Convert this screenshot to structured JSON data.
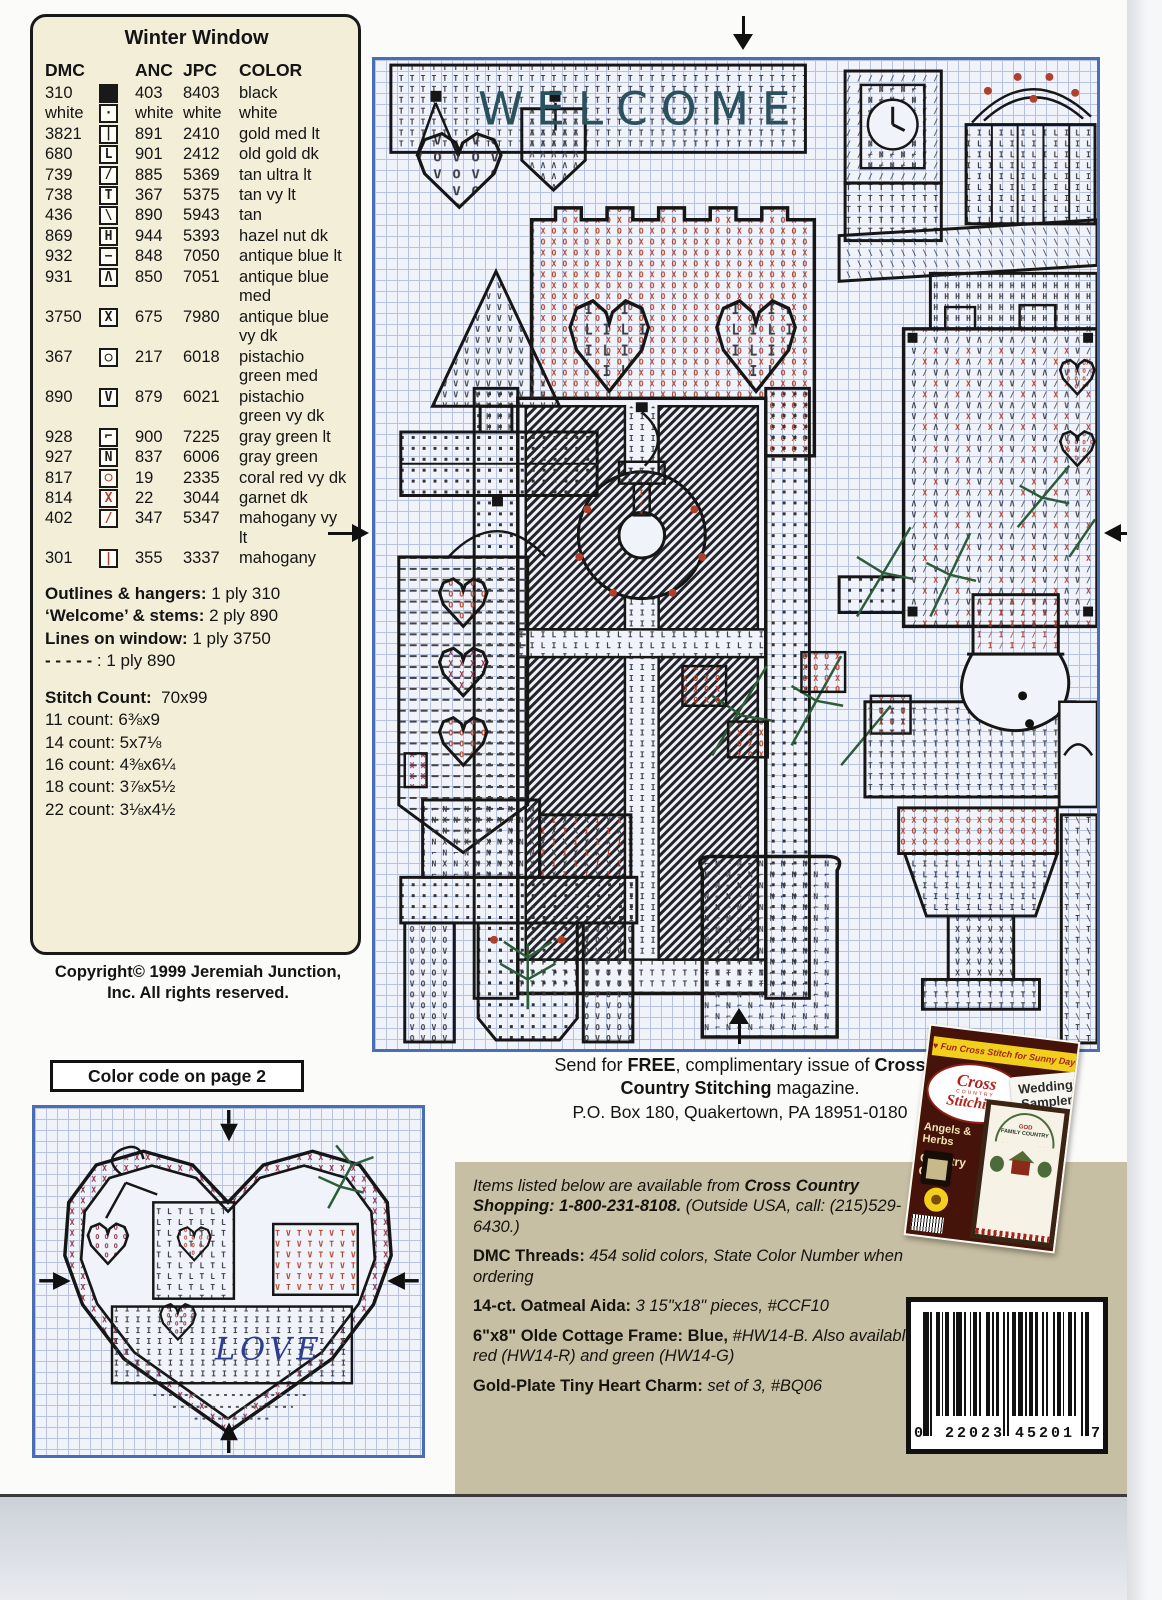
{
  "colors": {
    "chart_border": "#4a6db6",
    "grid_line": "#b7c3df",
    "key_bg": "#f3eed8",
    "panel_tan": "#c7bfa3",
    "symbol_red": "#b0402c",
    "symbol_maroon": "#8d2a45",
    "stitch_green": "#2d5c38",
    "welcome_teal": "#2b515e",
    "love_blue": "#2b3e8f",
    "magazine_yellow": "#f2cf1d",
    "magazine_maroon": "#451309"
  },
  "key": {
    "title": "Winter Window",
    "headers": {
      "dmc": "DMC",
      "anc": "ANC",
      "jpc": "JPC",
      "color": "COLOR"
    },
    "rows": [
      {
        "dmc": "310",
        "sym": "fill",
        "symColor": "k",
        "anc": "403",
        "jpc": "8403",
        "name": "black"
      },
      {
        "dmc": "white",
        "sym": "·",
        "symColor": "k",
        "anc": "white",
        "jpc": "white",
        "name": "white"
      },
      {
        "dmc": "3821",
        "sym": "|",
        "symColor": "k",
        "anc": "891",
        "jpc": "2410",
        "name": "gold med lt"
      },
      {
        "dmc": "680",
        "sym": "L",
        "symColor": "k",
        "anc": "901",
        "jpc": "2412",
        "name": "old gold dk"
      },
      {
        "dmc": "739",
        "sym": "/",
        "symColor": "k",
        "anc": "885",
        "jpc": "5369",
        "name": "tan ultra lt"
      },
      {
        "dmc": "738",
        "sym": "T",
        "symColor": "k",
        "anc": "367",
        "jpc": "5375",
        "name": "tan vy lt"
      },
      {
        "dmc": "436",
        "sym": "\\",
        "symColor": "k",
        "anc": "890",
        "jpc": "5943",
        "name": "tan"
      },
      {
        "dmc": "869",
        "sym": "H",
        "symColor": "k",
        "anc": "944",
        "jpc": "5393",
        "name": "hazel nut dk"
      },
      {
        "dmc": "932",
        "sym": "−",
        "symColor": "k",
        "anc": "848",
        "jpc": "7050",
        "name": "antique blue lt"
      },
      {
        "dmc": "931",
        "sym": "Λ",
        "symColor": "k",
        "anc": "850",
        "jpc": "7051",
        "name": "antique blue med"
      },
      {
        "dmc": "3750",
        "sym": "X",
        "symColor": "k",
        "anc": "675",
        "jpc": "7980",
        "name": "antique blue vy dk"
      },
      {
        "dmc": "367",
        "sym": "○",
        "symColor": "k",
        "anc": "217",
        "jpc": "6018",
        "name": "pistachio green med"
      },
      {
        "dmc": "890",
        "sym": "V",
        "symColor": "k",
        "anc": "879",
        "jpc": "6021",
        "name": "pistachio green vy dk"
      },
      {
        "dmc": "928",
        "sym": "⌐",
        "symColor": "k",
        "anc": "900",
        "jpc": "7225",
        "name": "gray green lt"
      },
      {
        "dmc": "927",
        "sym": "N",
        "symColor": "k",
        "anc": "837",
        "jpc": "6006",
        "name": "gray green"
      },
      {
        "dmc": "817",
        "sym": "○",
        "symColor": "r",
        "anc": "19",
        "jpc": "2335",
        "name": "coral red vy dk"
      },
      {
        "dmc": "814",
        "sym": "X",
        "symColor": "r",
        "anc": "22",
        "jpc": "3044",
        "name": "garnet dk"
      },
      {
        "dmc": "402",
        "sym": "/",
        "symColor": "r",
        "anc": "347",
        "jpc": "5347",
        "name": "mahogany vy lt"
      },
      {
        "dmc": "301",
        "sym": "|",
        "symColor": "r",
        "anc": "355",
        "jpc": "3337",
        "name": "mahogany"
      }
    ],
    "notes": [
      {
        "label": "Outlines & hangers:",
        "value": " 1 ply 310"
      },
      {
        "label": "‘Welcome’ & stems:",
        "value": " 2 ply 890"
      },
      {
        "label": "Lines on window:",
        "value": " 1 ply 3750"
      },
      {
        "label": "- - - - -",
        "value": " : 1 ply 890"
      }
    ],
    "stitch_count_label": "Stitch Count:",
    "stitch_count_value": "70x99",
    "sizes": [
      "11 count: 6⅜x9",
      "14 count: 5x7⅛",
      "16 count: 4⅜x6¼",
      "18 count: 3⅞x5½",
      "22 count: 3⅛x4½"
    ]
  },
  "copyright": {
    "line1": "Copyright© 1999 Jeremiah Junction,",
    "line2": "Inc.  All rights reserved."
  },
  "color_code_note": "Color code on page 2",
  "main_chart": {
    "welcome": "WELCOME",
    "motifs": [
      "welcome-banner",
      "hanging-heart",
      "pennant",
      "pine-tree",
      "heart-banner",
      "flower-basket",
      "window-with-wreath",
      "mantel-clock",
      "berry-basket",
      "roof",
      "patterned-quilt",
      "greenery",
      "snowman",
      "crock",
      "flower-urn",
      "garden-bench",
      "planter-boxes"
    ],
    "arrows": [
      "top-center",
      "bottom-center",
      "left-middle",
      "right-middle"
    ]
  },
  "heart_chart": {
    "word": "LOVE",
    "motifs": [
      "stepped-heart-border",
      "basket",
      "red-patch",
      "pine-sprig",
      "bow",
      "small-hearts"
    ],
    "arrows": [
      "top-center",
      "bottom-center",
      "left-middle",
      "right-middle"
    ]
  },
  "free_offer": {
    "pre": "Send for ",
    "free": "FREE",
    "mid": ", complimentary issue of ",
    "brand1": "Cross",
    "brand2": "Country Stitching",
    "post": " magazine.",
    "address": "P.O. Box 180, Quakertown, PA 18951-0180"
  },
  "items": {
    "intro": {
      "i1": "Items listed below are available from ",
      "b1": "Cross Country Shopping: 1-800-231-8108.",
      "i2": " (Outside USA, call: (215)529-6430.)"
    },
    "entries": [
      {
        "b": "DMC Threads:",
        "i": " 454 solid colors, State Color Number when ordering"
      },
      {
        "b": "14-ct. Oatmeal Aida:",
        "i": " 3 15\"x18\" pieces, #CCF10"
      },
      {
        "b": "6\"x8\" Olde Cottage Frame: Blue,",
        "i": " #HW14-B. Also available in red (HW14-R) and green (HW14-G)"
      },
      {
        "b": "Gold-Plate Tiny Heart Charm:",
        "i": " set of 3, #BQ06"
      }
    ]
  },
  "barcode": {
    "left": "0",
    "group1": "22023",
    "group2": "45201",
    "right": "7"
  },
  "magazine": {
    "banner": "♥ Fun Cross Stitch for Sunny Days",
    "logo_top": "Cross",
    "logo_mid": "COUNTRY",
    "logo_bot": "Stitching",
    "band_line1": "Wedding",
    "band_line2": "Sampler",
    "burst_line1": "22",
    "burst_line2": "Projects",
    "side1": "Angels &",
    "side2": "Herbs",
    "side3": "Country",
    "side4": "Clock",
    "sampler_word1": "GOD",
    "sampler_word2": "FAMILY",
    "sampler_word3": "COUNTRY"
  }
}
